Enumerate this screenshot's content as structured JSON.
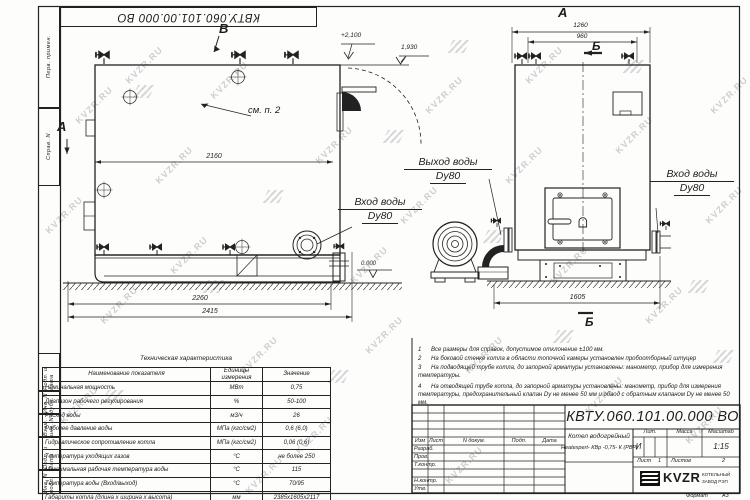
{
  "doc_number": "КВТУ.060.101.00.000  ВО",
  "watermark": {
    "text": "KVZR.RU"
  },
  "margin_labels": {
    "perv": "Перв. примен.",
    "sprav": "Справ. N",
    "podp1": "Подп. и дата",
    "inv_dubl": "Инв. N дубл.",
    "vzam": "Взам. инв. N",
    "podp2": "Подп. и дата",
    "inv_podl": "Инв. N подл."
  },
  "annotations": {
    "view_b": "В",
    "view_a_arrow": "А",
    "view_a_title": "А",
    "section_b_top": "Б",
    "section_b_bottom": "Б",
    "see_item": "см. п. 2",
    "elev_top": "+2,100",
    "elev_pipe": "1,930",
    "elev_zero": "0.000",
    "dim_2160": "2160",
    "dim_2260": "2260",
    "dim_2415": "2415",
    "dim_1260": "1260",
    "dim_960": "960",
    "dim_1605": "1605",
    "outlet": [
      "Выход воды",
      "Dy80"
    ],
    "inlet_front": [
      "Вход воды",
      "Dy80"
    ],
    "inlet_side": [
      "Вход воды",
      "Dy80"
    ]
  },
  "tech_table": {
    "title": "Техническая характеристика",
    "headers": [
      "Наименование показателя",
      "Единицы измерения",
      "Значение"
    ],
    "rows": [
      [
        "Номинальная мощность",
        "МВт",
        "0,75"
      ],
      [
        "Диапазон рабочего регулирования",
        "%",
        "50-100"
      ],
      [
        "Расход воды",
        "м3/ч",
        "26"
      ],
      [
        "Рабочее давление воды",
        "МПа (кгс/см2)",
        "0,6 (6,0)"
      ],
      [
        "Гидравлическое сопротивление котла",
        "МПа (кгс/см2)",
        "0,06 (0,6)"
      ],
      [
        "Температура уходящих газов",
        "°С",
        "не более 250"
      ],
      [
        "Максимальная рабочая температура воды",
        "°С",
        "115"
      ],
      [
        "Температура воды (Вход/выход)",
        "°С",
        "70/95"
      ],
      [
        "Габариты котла (длина х ширина х высота)",
        "мм",
        "2385х1605х2117"
      ]
    ]
  },
  "notes": {
    "items": [
      {
        "n": "1",
        "text": "Все размеры для справок, допустимое отклонение ±100 мм."
      },
      {
        "n": "2",
        "text": "На боковой стенке котла в области топочной камеры установлен пробоотборный штуцер"
      },
      {
        "n": "3",
        "text": "На подводящей трубе котла, до запорной арматуры установлены: манометр, прибор для измерения температуры."
      },
      {
        "n": "4",
        "text": "На отводящей трубе котла, до запорной арматуры установлены: манометр, прибор для измерения температуры, предохранительный клапан Dу не менее 50 мм и обвод с обратным клапаном Dу не менее 50 мм."
      }
    ]
  },
  "title_block": {
    "cols": [
      "Изм",
      "Лист",
      "N докум.",
      "Подп.",
      "Дата"
    ],
    "rows": [
      "Разраб.",
      "Пров.",
      "Т.контр.",
      "Н.контр.",
      "Утв."
    ],
    "title_line1": "Котел водогрейный",
    "title_line2": "Heatexpert- КВр -0,75- К (РВР)",
    "lit_header": "Лит.",
    "mass_header": "Масса",
    "scale_header": "Масштаб",
    "lit_value": "И",
    "scale_value": "1:15",
    "sheet_label": "Лист",
    "sheet_value": "1",
    "sheets_label": "Листов",
    "sheets_value": "2",
    "logo_text": "KVZR",
    "company_line1": "КОТЕЛЬНЫЙ",
    "company_line2": "ЗАВОД РЭП",
    "format_label": "Формат",
    "format_value": "А3"
  }
}
